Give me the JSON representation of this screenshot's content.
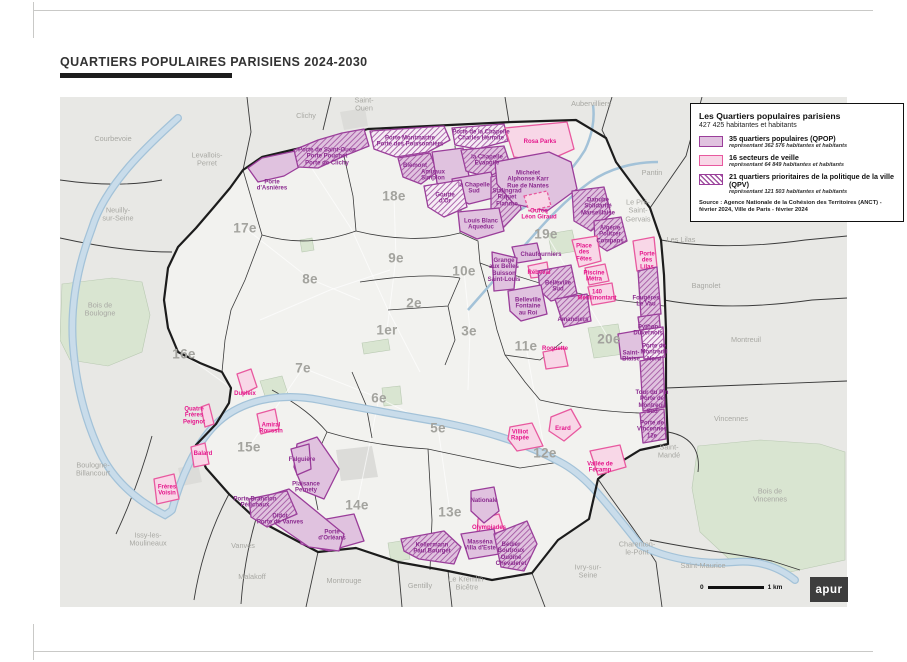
{
  "page": {
    "title": "QUARTIERS POPULAIRES PARISIENS 2024-2030"
  },
  "legend": {
    "title": "Les Quartiers populaires parisiens",
    "subtitle": "427 425 habitantes et habitants",
    "items": [
      {
        "label": "35 quartiers populaires (QPOP)",
        "sub": "représentant 362 576 habitantes et habitants"
      },
      {
        "label": "16 secteurs de veille",
        "sub": "représentant 64 849 habitantes et habitants"
      },
      {
        "label": "21 quartiers prioritaires de la politique de la ville (QPV)",
        "sub": "représentant 121 503 habitantes et habitants"
      }
    ],
    "source": "Source : Agence Nationale de la Cohésion des Territoires (ANCT) - février 2024, Ville de Paris - février 2024"
  },
  "scalebar": {
    "zero": "0",
    "unit": "1 km"
  },
  "logo": "apur",
  "colors": {
    "suburb": "#e8e8e5",
    "paris": "#f2f2ef",
    "green": "#d9e5d1",
    "river": "#c9dcea",
    "river_edge": "#a3c2d8",
    "gray": "#dcdcd9",
    "boundary": "#1c1c1c",
    "innerline": "#3a3a3a",
    "street": "#ffffff",
    "qpop_fill": "#e0c2df",
    "qpop_stroke": "#9a3d9a",
    "veille_fill": "#f8d7e7",
    "veille_stroke": "#e8599f",
    "qpv_fill": "#f6ecf5",
    "hatch": "#a052a0",
    "qpop_label": "#8b2b8f",
    "veille_label": "#e5178c"
  },
  "map": {
    "arrondissements": [
      {
        "label": "1er",
        "x": 387,
        "y": 330
      },
      {
        "label": "2e",
        "x": 414,
        "y": 303
      },
      {
        "label": "3e",
        "x": 469,
        "y": 331
      },
      {
        "label": "5e",
        "x": 438,
        "y": 428
      },
      {
        "label": "6e",
        "x": 379,
        "y": 398
      },
      {
        "label": "7e",
        "x": 303,
        "y": 368
      },
      {
        "label": "8e",
        "x": 310,
        "y": 279
      },
      {
        "label": "9e",
        "x": 396,
        "y": 258
      },
      {
        "label": "10e",
        "x": 464,
        "y": 271
      },
      {
        "label": "11e",
        "x": 526,
        "y": 346
      },
      {
        "label": "12e",
        "x": 545,
        "y": 453
      },
      {
        "label": "13e",
        "x": 450,
        "y": 512
      },
      {
        "label": "14e",
        "x": 357,
        "y": 505
      },
      {
        "label": "15e",
        "x": 249,
        "y": 447
      },
      {
        "label": "16e",
        "x": 184,
        "y": 354
      },
      {
        "label": "17e",
        "x": 245,
        "y": 228
      },
      {
        "label": "18e",
        "x": 394,
        "y": 196
      },
      {
        "label": "19e",
        "x": 546,
        "y": 234
      },
      {
        "label": "20e",
        "x": 609,
        "y": 339
      }
    ],
    "communes": [
      {
        "label": "Courbevoie",
        "x": 113,
        "y": 139
      },
      {
        "label": "Clichy",
        "x": 306,
        "y": 116
      },
      {
        "label": "Saint-\nOuen",
        "x": 364,
        "y": 105
      },
      {
        "label": "Aubervilliers",
        "x": 591,
        "y": 104
      },
      {
        "label": "Pantin",
        "x": 652,
        "y": 173
      },
      {
        "label": "Le Pré-\nSaint-\nGervais",
        "x": 638,
        "y": 211
      },
      {
        "label": "Les Lilas",
        "x": 681,
        "y": 240
      },
      {
        "label": "Bagnolet",
        "x": 706,
        "y": 286
      },
      {
        "label": "Montreuil",
        "x": 746,
        "y": 340
      },
      {
        "label": "Vincennes",
        "x": 731,
        "y": 419
      },
      {
        "label": "Saint-\nMandé",
        "x": 669,
        "y": 452
      },
      {
        "label": "Bois de\nVincennes",
        "x": 770,
        "y": 496
      },
      {
        "label": "Charenton-\nle-Pont",
        "x": 637,
        "y": 549
      },
      {
        "label": "Saint-Maurice",
        "x": 703,
        "y": 566
      },
      {
        "label": "Ivry-sur-\nSeine",
        "x": 588,
        "y": 572
      },
      {
        "label": "Le Kremlin-\nBicêtre",
        "x": 467,
        "y": 584
      },
      {
        "label": "Gentilly",
        "x": 420,
        "y": 586
      },
      {
        "label": "Montrouge",
        "x": 344,
        "y": 581
      },
      {
        "label": "Malakoff",
        "x": 252,
        "y": 577
      },
      {
        "label": "Vanves",
        "x": 243,
        "y": 546
      },
      {
        "label": "Issy-les-\nMoulineaux",
        "x": 148,
        "y": 540
      },
      {
        "label": "Boulogne-\nBillancourt",
        "x": 93,
        "y": 470
      },
      {
        "label": "Bois de\nBoulogne",
        "x": 100,
        "y": 310
      },
      {
        "label": "Neuilly-\nsur-Seine",
        "x": 118,
        "y": 215
      },
      {
        "label": "Levallois-\nPerret",
        "x": 207,
        "y": 160
      }
    ],
    "quartiers": [
      {
        "name": "Porte\nd'Asnières",
        "x": 272,
        "y": 186,
        "t": "qpop"
      },
      {
        "name": "Porte de Saint-Ouen\nPorte Pouchet\nPorte de Clichy",
        "x": 327,
        "y": 157,
        "t": "qpop"
      },
      {
        "name": "Porte Montmartre\nPorte des Poissonniers",
        "x": 410,
        "y": 142,
        "t": "qpop"
      },
      {
        "name": "Blémont",
        "x": 415,
        "y": 166,
        "t": "qpop"
      },
      {
        "name": "Amiraux\nSimplon",
        "x": 433,
        "y": 176,
        "t": "qpop"
      },
      {
        "name": "Porte de la Chapelle\nCharles Hermite",
        "x": 481,
        "y": 136,
        "t": "qpop"
      },
      {
        "name": "la Chapelle\nÉvangile",
        "x": 487,
        "y": 161,
        "t": "qpop"
      },
      {
        "name": "la Chapelle\nSud",
        "x": 474,
        "y": 189,
        "t": "qpop"
      },
      {
        "name": "Goutte\nd'Or",
        "x": 445,
        "y": 199,
        "t": "qpop"
      },
      {
        "name": "Stalingrad\nRiquet\nFlandre",
        "x": 507,
        "y": 198,
        "t": "qpop"
      },
      {
        "name": "Louis Blanc\nAqueduc",
        "x": 481,
        "y": 225,
        "t": "qpop"
      },
      {
        "name": "Rosa Parks",
        "x": 540,
        "y": 142,
        "t": "veille"
      },
      {
        "name": "Michelet\nAlphonse Karr\nRue de Nantes",
        "x": 528,
        "y": 180,
        "t": "qpop"
      },
      {
        "name": "Ourcq\nLéon Giraud",
        "x": 539,
        "y": 215,
        "t": "veille"
      },
      {
        "name": "Danube\nSolidarité\nMarseillaise",
        "x": 598,
        "y": 207,
        "t": "qpop"
      },
      {
        "name": "Algérie\nPolitzer\nCompans",
        "x": 610,
        "y": 235,
        "t": "qpop"
      },
      {
        "name": "Place\ndes\nFêtes",
        "x": 584,
        "y": 253,
        "t": "veille"
      },
      {
        "name": "Chaufourniers",
        "x": 541,
        "y": 255,
        "t": "qpop"
      },
      {
        "name": "Grange\naux Belles\nBuisson\nSaint-Louis",
        "x": 504,
        "y": 271,
        "t": "qpop"
      },
      {
        "name": "Rébeval",
        "x": 539,
        "y": 273,
        "t": "veille"
      },
      {
        "name": "Piscine\nMétra",
        "x": 594,
        "y": 277,
        "t": "veille"
      },
      {
        "name": "Porte\ndes\nLilas",
        "x": 647,
        "y": 261,
        "t": "veille"
      },
      {
        "name": "Belleville\nSud",
        "x": 558,
        "y": 287,
        "t": "qpop"
      },
      {
        "name": "140\nMénilmontant",
        "x": 597,
        "y": 296,
        "t": "veille"
      },
      {
        "name": "Fougères\nLe Vau",
        "x": 646,
        "y": 302,
        "t": "qpop"
      },
      {
        "name": "Belleville\nFontaine\nau Roi",
        "x": 528,
        "y": 307,
        "t": "qpop"
      },
      {
        "name": "Amandiers",
        "x": 573,
        "y": 320,
        "t": "qpop"
      },
      {
        "name": "Python\nDuvernois",
        "x": 648,
        "y": 331,
        "t": "qpop"
      },
      {
        "name": "Roquette",
        "x": 555,
        "y": 349,
        "t": "veille"
      },
      {
        "name": "Saint-\nBlaise",
        "x": 631,
        "y": 357,
        "t": "qpop"
      },
      {
        "name": "Porte de\nMontreuil\nNord",
        "x": 654,
        "y": 353,
        "t": "qpop"
      },
      {
        "name": "Tour du Pin\nPorte de\nMontreuil\nSud",
        "x": 652,
        "y": 403,
        "t": "qpop"
      },
      {
        "name": "Porte de\nVincennes\n12e",
        "x": 652,
        "y": 430,
        "t": "qpop"
      },
      {
        "name": "Villiot\nRapée",
        "x": 520,
        "y": 436,
        "t": "veille"
      },
      {
        "name": "Erard",
        "x": 563,
        "y": 429,
        "t": "veille"
      },
      {
        "name": "Vallée de\nFécamp",
        "x": 600,
        "y": 468,
        "t": "veille"
      },
      {
        "name": "Olympiades",
        "x": 489,
        "y": 528,
        "t": "veille"
      },
      {
        "name": "Nationale",
        "x": 484,
        "y": 501,
        "t": "qpop"
      },
      {
        "name": "Kellermann\nPaul Bourget",
        "x": 432,
        "y": 549,
        "t": "qpop"
      },
      {
        "name": "Masséna\nVilla d'Este",
        "x": 480,
        "y": 546,
        "t": "qpop"
      },
      {
        "name": "Bédier\nBoutroux\nOudiné\nChevaleret",
        "x": 511,
        "y": 555,
        "t": "qpop"
      },
      {
        "name": "Porte\nd'Orléans",
        "x": 332,
        "y": 536,
        "t": "qpop"
      },
      {
        "name": "Didot\nPorte de Vanves",
        "x": 280,
        "y": 520,
        "t": "qpop"
      },
      {
        "name": "Porte Brancion\nPérichaux",
        "x": 255,
        "y": 503,
        "t": "qpop"
      },
      {
        "name": "Plaisance\nPernety",
        "x": 306,
        "y": 488,
        "t": "qpop"
      },
      {
        "name": "Falguière",
        "x": 302,
        "y": 460,
        "t": "qpop"
      },
      {
        "name": "Dupleix",
        "x": 245,
        "y": 394,
        "t": "veille"
      },
      {
        "name": "Quatre\nFrères\nPeignot",
        "x": 194,
        "y": 416,
        "t": "veille"
      },
      {
        "name": "Amiral\nRoussin",
        "x": 271,
        "y": 429,
        "t": "veille"
      },
      {
        "name": "Balard",
        "x": 203,
        "y": 454,
        "t": "veille"
      },
      {
        "name": "Frères\nVoisin",
        "x": 167,
        "y": 491,
        "t": "veille"
      }
    ],
    "polygons": [
      {
        "t": "qpop",
        "pts": "248,168 262,158 300,150 306,163 284,176 258,182"
      },
      {
        "t": "qpop",
        "h": true,
        "pts": "294,150 318,140 342,133 364,129 369,146 344,156 318,168 298,167"
      },
      {
        "t": "qpv",
        "pts": "370,131 444,126 450,140 428,152 396,157 374,149"
      },
      {
        "t": "qpop",
        "h": true,
        "pts": "398,158 430,153 437,172 421,184 403,177"
      },
      {
        "t": "qpop",
        "pts": "432,152 463,148 469,176 451,193 437,183"
      },
      {
        "t": "qpv",
        "pts": "452,128 504,124 508,141 477,149 455,145"
      },
      {
        "t": "qpop",
        "h": true,
        "pts": "461,150 504,146 511,167 487,177 466,171"
      },
      {
        "t": "qpop",
        "pts": "452,179 491,172 497,197 469,204 455,197"
      },
      {
        "t": "qpv",
        "pts": "424,186 461,180 467,207 444,217 428,207"
      },
      {
        "t": "qpop",
        "h": true,
        "pts": "491,177 514,171 521,209 504,227 491,214"
      },
      {
        "t": "qpop",
        "pts": "458,212 499,208 504,231 477,239 460,231"
      },
      {
        "t": "veille",
        "pts": "505,128 567,122 574,149 547,161 514,157"
      },
      {
        "t": "qpop",
        "pts": "495,162 549,152 571,162 577,189 547,211 514,204 497,184"
      },
      {
        "t": "veille",
        "dash": true,
        "pts": "524,196 547,191 551,206 529,211"
      },
      {
        "t": "qpop",
        "h": true,
        "pts": "572,191 604,187 611,214 591,231 574,221"
      },
      {
        "t": "qpop",
        "h": true,
        "pts": "594,221 621,217 627,241 607,251 595,243"
      },
      {
        "t": "veille",
        "pts": "572,240 597,236 601,261 579,267"
      },
      {
        "t": "qpop",
        "pts": "512,247 537,243 541,259 517,263"
      },
      {
        "t": "qpop",
        "pts": "492,252 517,258 514,289 494,291"
      },
      {
        "t": "veille",
        "pts": "528,266 547,262 549,276 531,278"
      },
      {
        "t": "veille",
        "pts": "585,268 605,264 609,281 589,285"
      },
      {
        "t": "veille",
        "pts": "633,241 654,237 657,267 637,271"
      },
      {
        "t": "qpop",
        "h": true,
        "pts": "538,271 571,265 577,294 551,301 540,291"
      },
      {
        "t": "veille",
        "pts": "588,287 612,283 615,301 592,305"
      },
      {
        "t": "qpop",
        "h": true,
        "pts": "638,271 657,267 661,314 641,317"
      },
      {
        "t": "qpop",
        "pts": "508,291 541,285 547,314 521,321 510,311"
      },
      {
        "t": "qpop",
        "h": true,
        "pts": "555,299 587,294 591,321 564,327"
      },
      {
        "t": "qpop",
        "h": true,
        "pts": "638,317 659,314 661,337 641,339"
      },
      {
        "t": "veille",
        "pts": "543,352 564,348 568,366 546,369"
      },
      {
        "t": "qpop",
        "pts": "618,334 641,330 644,357 621,359"
      },
      {
        "t": "qpv",
        "pts": "641,330 663,327 665,357 644,359"
      },
      {
        "t": "qpop",
        "h": true,
        "pts": "640,361 663,357 665,407 643,411"
      },
      {
        "t": "qpop",
        "h": true,
        "pts": "640,413 664,409 666,439 643,443"
      },
      {
        "t": "veille",
        "pts": "510,427 532,423 543,446 517,451 508,439"
      },
      {
        "t": "veille",
        "pts": "551,417 571,409 581,427 564,441 549,431"
      },
      {
        "t": "veille",
        "pts": "590,451 620,445 626,467 598,475"
      },
      {
        "t": "veille",
        "pts": "478,519 499,514 506,537 487,547 477,537"
      },
      {
        "t": "qpop",
        "pts": "471,491 494,487 499,511 484,523 471,511"
      },
      {
        "t": "qpop",
        "h": true,
        "pts": "401,539 444,531 461,547 454,564 419,559 404,551"
      },
      {
        "t": "qpop",
        "pts": "461,534 494,529 499,554 469,559"
      },
      {
        "t": "qpop",
        "h": true,
        "pts": "494,534 527,521 537,544 524,571 501,567"
      },
      {
        "t": "qpop",
        "pts": "299,524 354,514 364,541 329,551 301,544"
      },
      {
        "t": "qpop",
        "pts": "257,499 289,489 344,534 339,551 309,547 261,514"
      },
      {
        "t": "qpop",
        "h": true,
        "pts": "249,499 287,491 297,514 267,527 251,517"
      },
      {
        "t": "qpop",
        "pts": "297,444 317,437 339,469 324,499 304,491 294,467"
      },
      {
        "t": "qpop",
        "pts": "291,449 309,444 311,469 297,475"
      },
      {
        "t": "veille",
        "pts": "237,374 251,369 257,387 243,394"
      },
      {
        "t": "veille",
        "pts": "201,407 209,404 214,424 205,427"
      },
      {
        "t": "veille",
        "pts": "257,414 275,409 279,429 261,434"
      },
      {
        "t": "veille",
        "pts": "191,447 205,443 209,464 194,467"
      },
      {
        "t": "veille",
        "pts": "154,479 174,474 179,499 157,504"
      }
    ],
    "base": {
      "paris_outline": "243,170 262,157 296,149 368,129 450,125 512,122 576,120 606,138 616,162 650,208 661,240 664,275 666,330 666,395 668,444 640,450 614,466 598,479 589,519 558,540 532,573 492,580 448,571 398,562 356,548 318,552 284,534 256,519 229,494 206,468 196,445 216,424 229,403 231,388 222,372 200,363 178,352 168,328 164,300 168,268 178,247 196,228 214,207 230,188",
      "greens": [
        "62,284 112,278 142,282 150,315 142,352 108,366 70,360 60,340",
        "698,446 760,440 820,444 845,452 845,560 790,572 730,560 700,532 692,488",
        "548,234 572,230 577,251 552,255",
        "588,328 618,324 624,354 594,358",
        "382,388 400,386 402,404 384,406",
        "260,381 282,376 289,397 267,402",
        "388,543 407,540 410,559 391,562",
        "300,240 312,238 314,250 302,252",
        "362,343 388,339 390,350 364,354"
      ],
      "grays": [
        "336,450 372,446 378,477 341,481",
        "178,468 198,464 202,482 182,486",
        "340,112 365,108 368,126 344,130"
      ],
      "seine": "M 640,545 C 600,495 585,475 560,462 C 520,440 480,430 440,422 C 400,415 360,408 320,400 C 280,392 240,400 215,425 C 195,445 180,480 172,510 M 178,118 C 148,145 105,185 92,228 C 78,265 70,305 73,345 C 76,385 85,420 100,452 C 112,478 135,500 165,515 C 168,513 170,512 172,510 M 640,545 C 665,558 700,565 735,562 C 760,560 780,568 795,580",
      "canal": "M 468,310 C 490,285 510,262 525,245 C 545,222 565,200 590,182 C 610,168 635,162 658,162 M 520,210 C 545,195 570,175 585,150 C 592,135 595,120 593,105",
      "suburb_lines": [
        "M 60,238 C 105,248 140,252 172,252",
        "M 247,97 L 251,132 L 243,170",
        "M 331,97 L 323,130",
        "M 505,97 L 509,122",
        "M 612,97 L 602,130 L 606,138",
        "M 702,97 L 686,156 L 650,208",
        "M 661,240 C 705,248 755,247 805,240 L 847,236",
        "M 664,300 C 712,309 762,307 812,300 L 847,298",
        "M 666,388 C 722,386 782,384 847,381",
        "M 668,432 C 696,437 700,456 698,472",
        "M 598,479 C 616,506 637,532 656,562 L 662,607",
        "M 532,573 L 545,607",
        "M 448,571 L 452,607",
        "M 398,562 L 402,607",
        "M 318,552 L 306,607",
        "M 256,519 C 248,546 243,576 241,604",
        "M 229,494 C 212,526 200,562 194,600",
        "M 152,436 C 142,472 130,504 116,534",
        "M 650,540 C 692,549 732,553 772,561 L 800,570",
        "M 60,180 C 95,185 130,186 162,180"
      ],
      "arr_lines": [
        "M 344,156 L 353,196 L 356,231",
        "M 356,231 C 392,240 430,241 460,233",
        "M 455,146 L 461,210 L 460,233",
        "M 460,233 L 478,241 L 480,263",
        "M 480,263 C 520,278 560,290 600,298 L 664,306",
        "M 480,263 L 490,300 L 497,330 L 505,355 L 525,382 L 540,400",
        "M 540,400 C 575,408 610,412 640,413",
        "M 262,235 C 300,246 330,240 356,231",
        "M 243,170 L 262,235",
        "M 262,235 L 245,280 L 231,310 L 225,340 L 222,372",
        "M 360,282 C 400,276 435,274 460,278",
        "M 327,432 L 310,470 L 318,510",
        "M 327,432 C 360,442 395,447 428,449",
        "M 428,449 L 432,520 L 430,570",
        "M 428,449 C 460,456 490,462 520,468 L 560,462",
        "M 352,372 L 366,405 L 372,438",
        "M 272,390 C 300,405 315,418 327,432",
        "M 388,310 L 448,306 L 460,278",
        "M 448,306 L 455,340 L 445,365",
        "M 505,355 L 540,360 L 562,342"
      ],
      "streets": [
        "M 300,150 L 352,230 L 388,310 L 420,372",
        "M 394,196 L 396,258 L 387,330",
        "M 245,228 L 310,279 L 360,300",
        "M 464,271 L 470,330 L 468,390",
        "M 184,354 L 231,388",
        "M 249,447 L 303,368",
        "M 357,505 L 379,398",
        "M 450,512 L 438,428",
        "M 545,453 L 526,346",
        "M 609,339 L 546,234",
        "M 303,368 L 379,398 L 438,428",
        "M 260,320 L 330,290 L 390,270"
      ]
    }
  }
}
